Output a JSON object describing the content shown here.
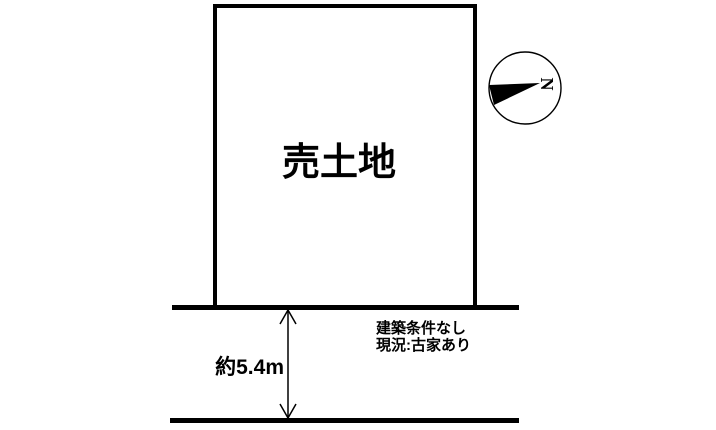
{
  "diagram": {
    "plot_label": "売土地",
    "compass": {
      "north_label": "N"
    },
    "road": {
      "width_label": "約5.4m"
    },
    "notes": {
      "line1": "建築条件なし",
      "line2": "現況:古家あり"
    },
    "colors": {
      "ink": "#000000",
      "background": "#ffffff"
    }
  }
}
